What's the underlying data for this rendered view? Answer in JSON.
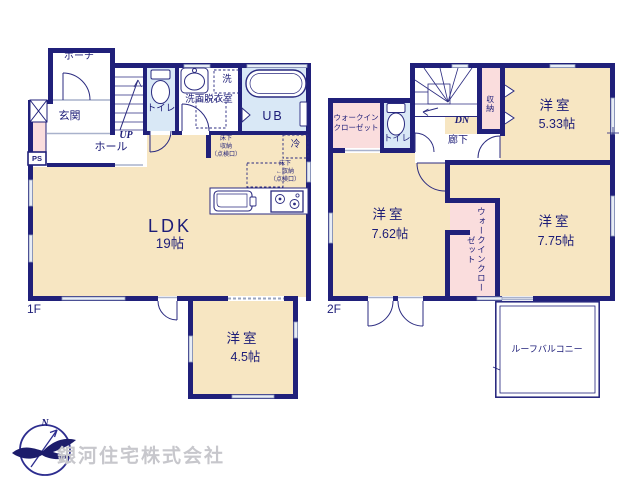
{
  "floor1": {
    "label": "1F",
    "porch": "ポーチ",
    "entrance": "玄関",
    "hall": "ホール",
    "stairs_up": "UP",
    "pipe_space": "PS",
    "toilet": "トイレ",
    "washroom": "洗面脱衣室",
    "washer": "洗",
    "unit_bath": "UB",
    "fridge": "冷",
    "underfloor_storage_1": "床下\n収納\n（点検口）",
    "underfloor_storage_2": "床下\n←収納\n（点検口）",
    "ldk_name": "LDK",
    "ldk_size": "19帖",
    "bedroom_name": "洋室",
    "bedroom_size": "4.5帖"
  },
  "floor2": {
    "label": "2F",
    "stairs_down": "DN",
    "corridor": "廊下",
    "toilet": "トイレ",
    "closet": "収納",
    "walkin_closet_top": "ウォークイン\nクローゼット",
    "walkin_closet_mid": "ウォークインクローゼット",
    "bedroom1_name": "洋室",
    "bedroom1_size": "5.33帖",
    "bedroom2_name": "洋室",
    "bedroom2_size": "7.62帖",
    "bedroom3_name": "洋室",
    "bedroom3_size": "7.75帖",
    "balcony": "ルーフバルコニー"
  },
  "logo": {
    "company": "銀河住宅株式会社",
    "compass_north": "N"
  },
  "colors": {
    "wall": "#20207a",
    "room_tan": "#f7e6c2",
    "room_pink": "#fadddd",
    "room_blue": "#d9e8f6",
    "window": "#e8edf6"
  }
}
